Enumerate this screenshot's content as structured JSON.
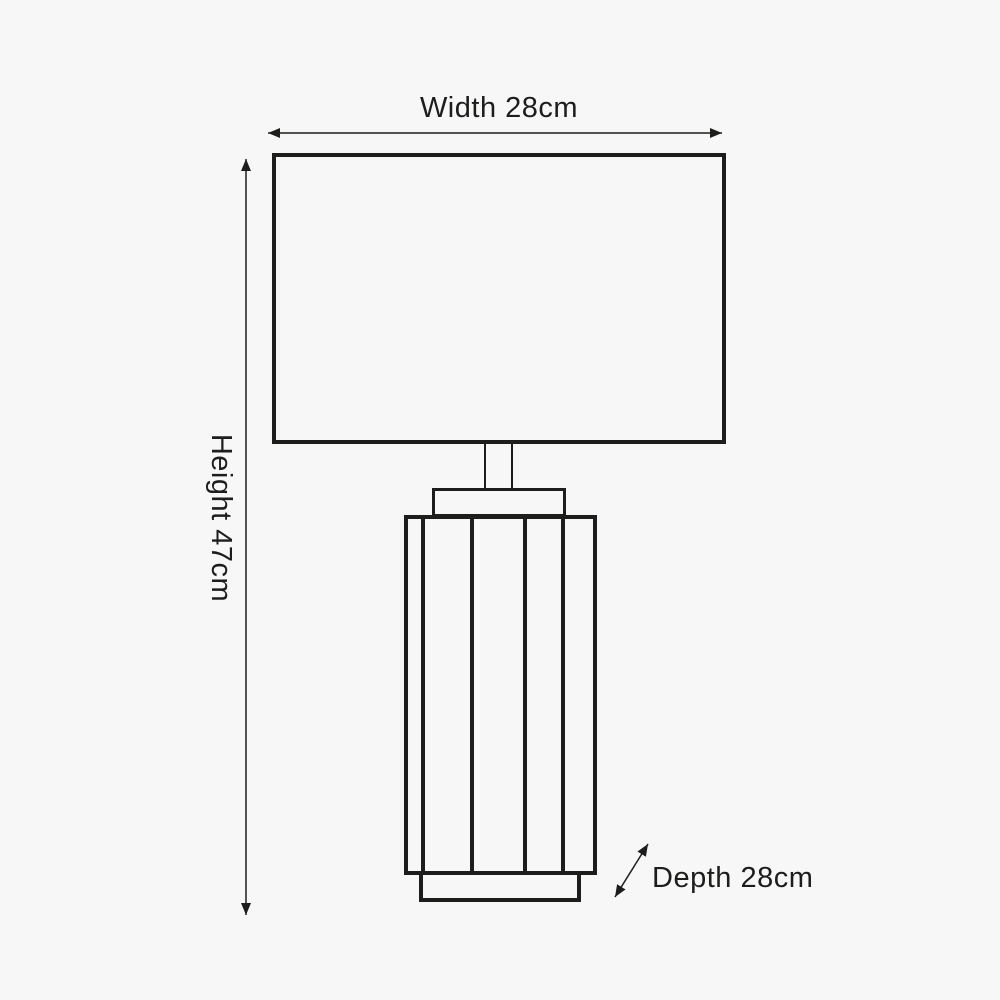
{
  "diagram": {
    "labels": {
      "width": "Width 28cm",
      "height": "Height 47cm",
      "depth": "Depth 28cm"
    },
    "values": {
      "width_cm": 28,
      "height_cm": 47,
      "depth_cm": 28,
      "unit": "cm"
    },
    "colors": {
      "background": "#f7f7f7",
      "line": "#1d1d1b",
      "text": "#1d1d1b"
    }
  }
}
